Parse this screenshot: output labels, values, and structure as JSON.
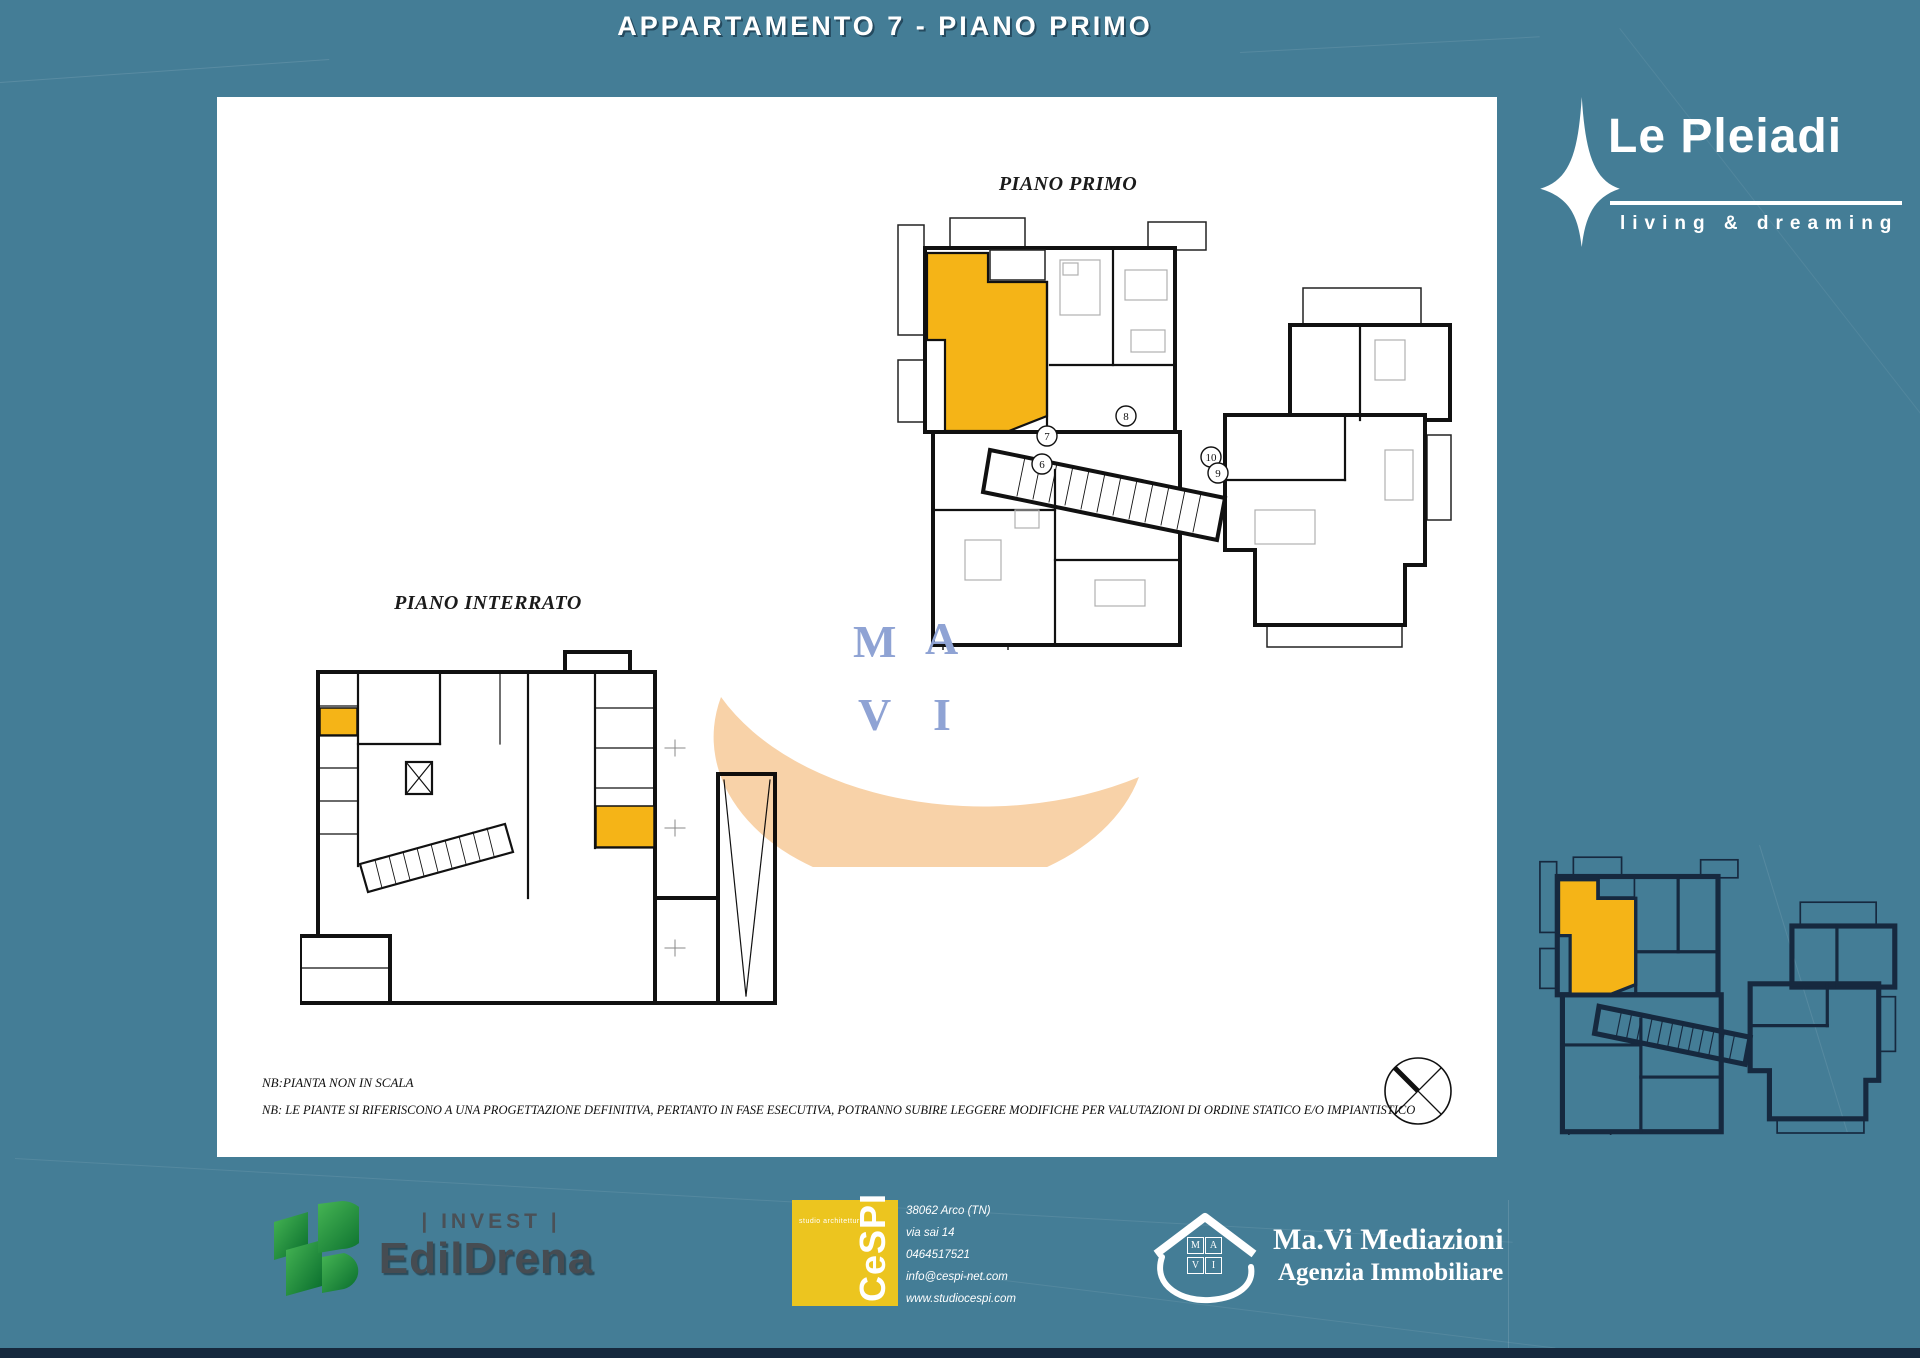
{
  "header": {
    "title": "APPARTAMENTO 7 - PIANO PRIMO"
  },
  "brand": {
    "name": "Le Pleiadi",
    "tagline": "living & dreaming"
  },
  "plans": {
    "primo": {
      "label": "PIANO PRIMO",
      "unit_numbers": [
        "6",
        "7",
        "8",
        "9",
        "10"
      ]
    },
    "interrato": {
      "label": "PIANO INTERRATO"
    }
  },
  "watermark": {
    "letters": [
      "M",
      "A",
      "V",
      "I"
    ]
  },
  "notes": {
    "line1": "NB:PIANTA NON IN SCALA",
    "line2": "NB: LE PIANTE SI RIFERISCONO A UNA PROGETTAZIONE DEFINITIVA, PERTANTO IN FASE ESECUTIVA, POTRANNO SUBIRE LEGGERE MODIFICHE PER VALUTAZIONI DI ORDINE STATICO E/O IMPIANTISTICO"
  },
  "footer": {
    "edildrena": {
      "invest": "| INVEST |",
      "name": "EdilDrena"
    },
    "cespi": {
      "studio": "studio architettura",
      "name": "CeSPI",
      "address_line1": "38062 Arco (TN)",
      "address_line2": "via sai 14",
      "phone": "0464517521",
      "email": "info@cespi-net.com",
      "website": "www.studiocespi.com"
    },
    "mavi": {
      "letters": [
        "M",
        "A",
        "V",
        "I"
      ],
      "name": "Ma.Vi Mediazioni",
      "subtitle": "Agenzia Immobiliare"
    }
  },
  "colors": {
    "background_teal": "#447d96",
    "navy": "#16293e",
    "highlight_yellow": "#f5b417",
    "swoosh_orange": "#f8d2a8",
    "watermark_blue": "#8fa3d4",
    "cespi_yellow": "#ecc51f",
    "edildrena_green": "#1d9a3f"
  }
}
